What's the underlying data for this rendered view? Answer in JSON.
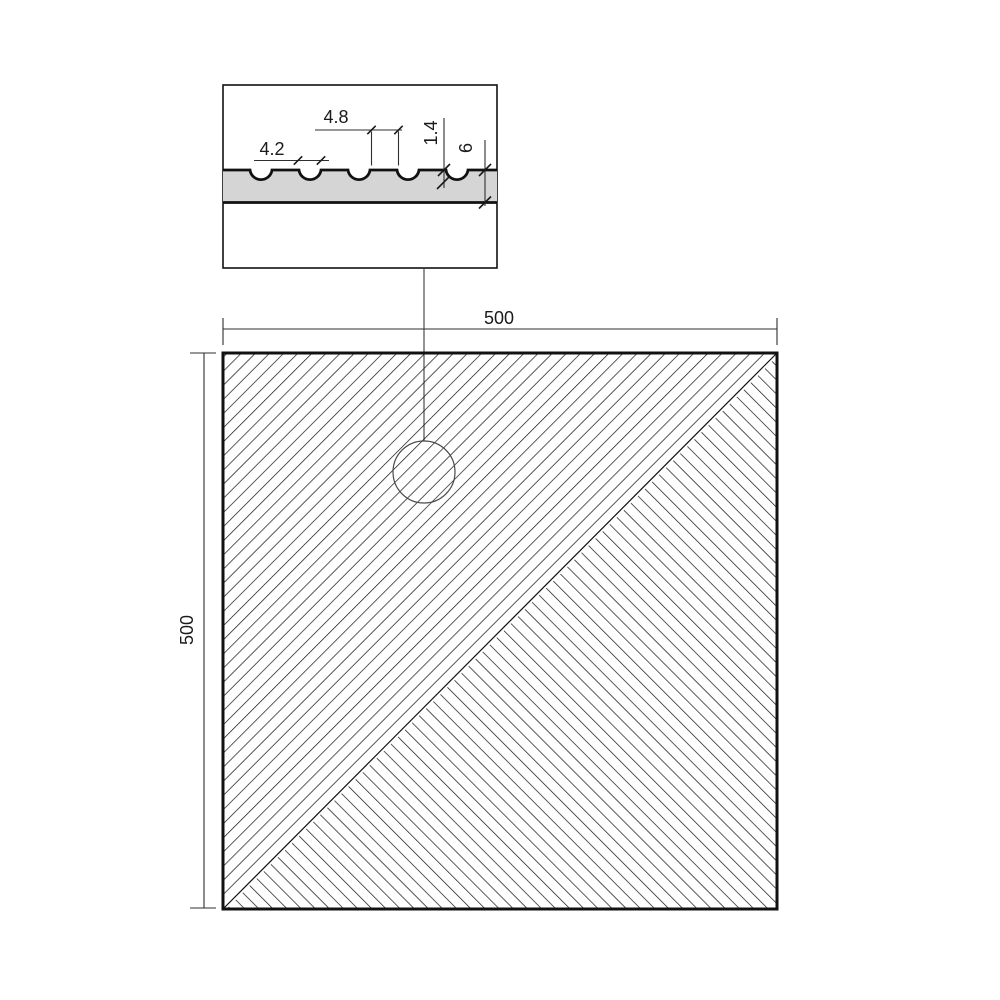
{
  "detail_view": {
    "groove_width_label": "4.2",
    "groove_spacing_label": "4.8",
    "groove_depth_label": "1.4",
    "thickness_label": "6"
  },
  "plan_view": {
    "width_label": "500",
    "height_label": "500"
  },
  "colors": {
    "line": "#111111",
    "dim_line": "#2f2f2f",
    "strip_fill": "#d5d5d5",
    "background": "#ffffff"
  }
}
